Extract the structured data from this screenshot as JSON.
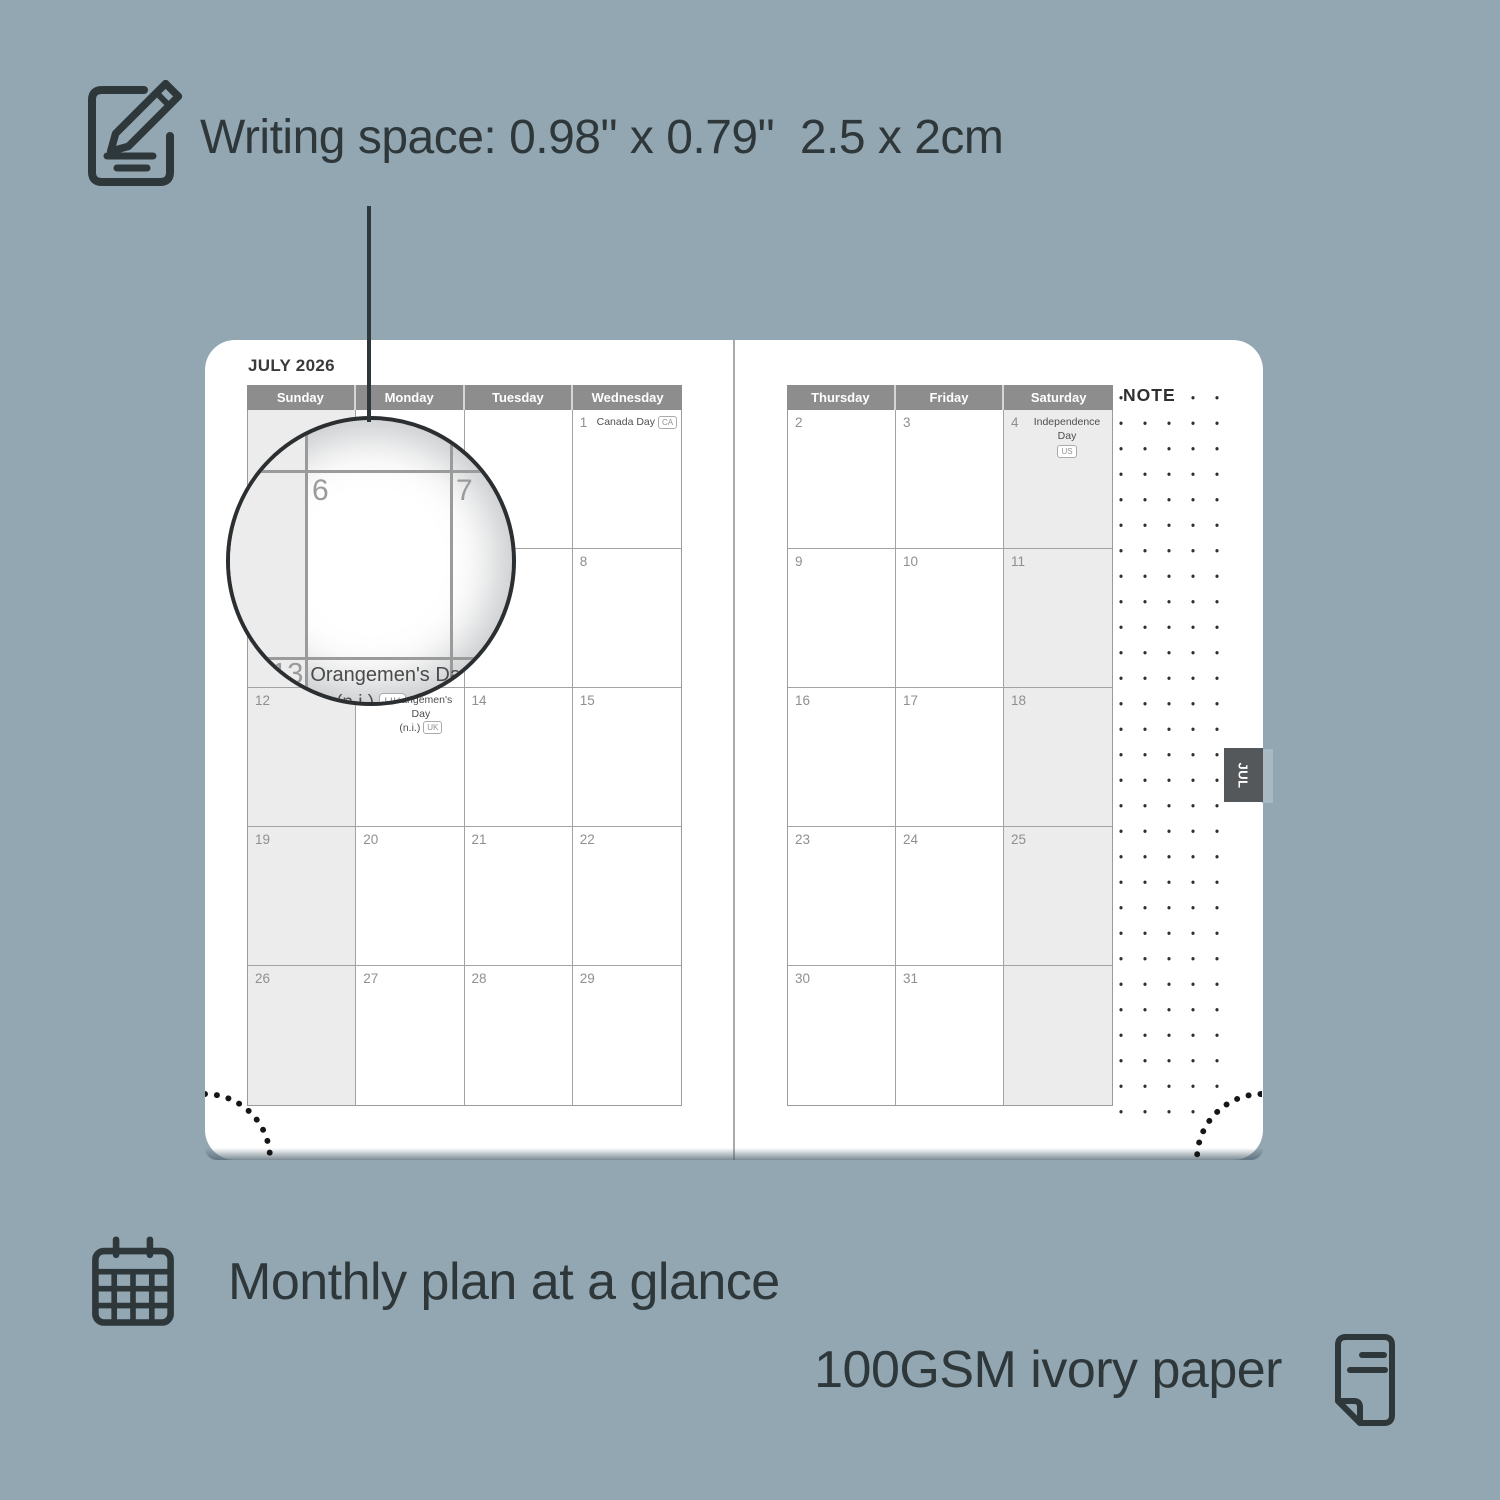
{
  "colors": {
    "background": "#93a7b3",
    "ink": "#2e373a",
    "page": "#ffffff",
    "header_bar": "#8d8d8d",
    "weekend_shade": "#ececec",
    "grid_line": "#a3a3a3",
    "day_number": "#8f8f8f",
    "tab": "#54585a",
    "holiday_text": "#4e4e4e"
  },
  "top_annotation": {
    "text": "Writing space: 0.98\" x 0.79\"  2.5 x 2cm",
    "icon": "notepad-pencil-icon"
  },
  "planner": {
    "title": "JULY 2026",
    "left_headers": [
      "Sunday",
      "Monday",
      "Tuesday",
      "Wednesday"
    ],
    "right_headers": [
      "Thursday",
      "Friday",
      "Saturday"
    ],
    "note_label": "NOTE",
    "tab_label": "JUL",
    "left_rows": [
      [
        {
          "day": "",
          "shaded": true
        },
        {
          "day": ""
        },
        {
          "day": ""
        },
        {
          "day": "1",
          "holiday": "Canada Day",
          "badge": "CA",
          "layout": "inline"
        }
      ],
      [
        {
          "day": "",
          "shaded": true
        },
        {
          "day": ""
        },
        {
          "day": ""
        },
        {
          "day": "8"
        }
      ],
      [
        {
          "day": "12",
          "shaded": true
        },
        {
          "day": "13",
          "holiday": "Orangemen's Day",
          "holiday2": "(n.i.)",
          "badge": "UK",
          "layout": "twoline"
        },
        {
          "day": "14"
        },
        {
          "day": "15"
        }
      ],
      [
        {
          "day": "19",
          "shaded": true
        },
        {
          "day": "20"
        },
        {
          "day": "21"
        },
        {
          "day": "22"
        }
      ],
      [
        {
          "day": "26",
          "shaded": true
        },
        {
          "day": "27"
        },
        {
          "day": "28"
        },
        {
          "day": "29"
        }
      ]
    ],
    "right_rows": [
      [
        {
          "day": "2"
        },
        {
          "day": "3"
        },
        {
          "day": "4",
          "holiday": "Independence Day",
          "badge": "US",
          "layout": "below",
          "shaded": true
        }
      ],
      [
        {
          "day": "9"
        },
        {
          "day": "10"
        },
        {
          "day": "11",
          "shaded": true
        }
      ],
      [
        {
          "day": "16"
        },
        {
          "day": "17"
        },
        {
          "day": "18",
          "shaded": true
        }
      ],
      [
        {
          "day": "23"
        },
        {
          "day": "24"
        },
        {
          "day": "25",
          "shaded": true
        }
      ],
      [
        {
          "day": "30"
        },
        {
          "day": "31"
        },
        {
          "day": "",
          "shaded": true
        }
      ]
    ]
  },
  "magnifier": {
    "day_a": "6",
    "day_b": "7",
    "holiday_day": "13",
    "holiday_text": "Orangemen's Day",
    "holiday_text2": "(n.i.)",
    "holiday_badge": "UK"
  },
  "captions": {
    "monthly": "Monthly plan at a glance",
    "monthly_icon": "calendar-grid-icon",
    "paper": "100GSM ivory paper",
    "paper_icon": "paper-sheet-icon"
  }
}
